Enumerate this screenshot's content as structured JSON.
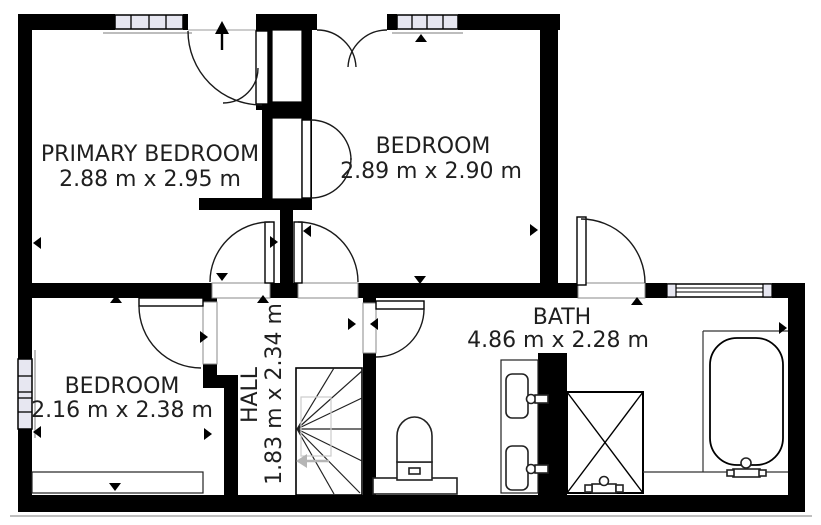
{
  "rooms": [
    {
      "name": "PRIMARY BEDROOM",
      "dimensions": "2.88 m x 2.95 m"
    },
    {
      "name": "BEDROOM",
      "dimensions": "2.89 m x 2.90 m"
    },
    {
      "name": "BEDROOM",
      "dimensions": "2.16 m x 2.38 m"
    },
    {
      "name": "HALL",
      "dimensions": "1.83 m x 2.34 m"
    },
    {
      "name": "BATH",
      "dimensions": "4.86 m x 2.28 m"
    }
  ],
  "colors": {
    "wall": "#000000",
    "text": "#1f1f1f",
    "window_pane": "#e7e7f1",
    "stairs_accent": "#b5b5b5"
  }
}
